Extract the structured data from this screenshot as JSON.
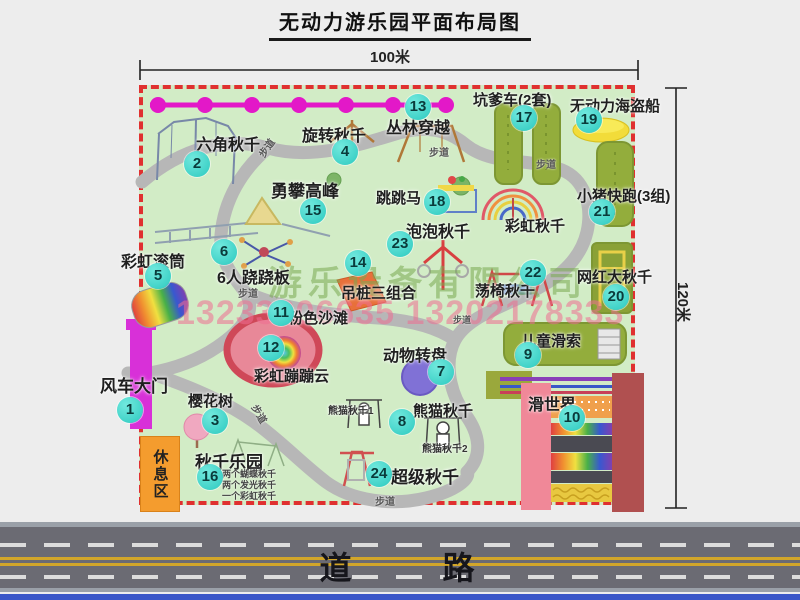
{
  "title": "无动力游乐园平面布局图",
  "dimensions": {
    "top": "100米",
    "right": "120米"
  },
  "road_label": "道 路",
  "watermark": {
    "company": "游乐设备有限公司",
    "phone": "13233806635 13202178333"
  },
  "rest_area_label": "休息区",
  "rainbow_swing_label": "彩虹秋千",
  "path_label": "步道",
  "panda_swing_labels": [
    "熊猫秋千1",
    "熊猫秋千2"
  ],
  "swing_park_notes": [
    "两个蝴蝶秋千",
    "两个发光秋千",
    "一个彩虹秋千"
  ],
  "items": [
    {
      "num": "1",
      "label": "风车大门"
    },
    {
      "num": "2",
      "label": "六角秋千"
    },
    {
      "num": "3",
      "label": "樱花树"
    },
    {
      "num": "4",
      "label": "旋转秋千"
    },
    {
      "num": "5",
      "label": "彩虹滚筒"
    },
    {
      "num": "6",
      "label": "6人跷跷板"
    },
    {
      "num": "7",
      "label": "动物转盘"
    },
    {
      "num": "8",
      "label": "熊猫秋千"
    },
    {
      "num": "9",
      "label": "儿童滑索"
    },
    {
      "num": "10",
      "label": "滑世界"
    },
    {
      "num": "11",
      "label": "粉色沙滩"
    },
    {
      "num": "12",
      "label": "彩虹蹦蹦云"
    },
    {
      "num": "13",
      "label": "丛林穿越"
    },
    {
      "num": "14",
      "label": "吊桩三组合"
    },
    {
      "num": "15",
      "label": "勇攀高峰"
    },
    {
      "num": "16",
      "label": "秋千乐园"
    },
    {
      "num": "17",
      "label": "坑爹车(2套)"
    },
    {
      "num": "18",
      "label": "跳跳马"
    },
    {
      "num": "19",
      "label": "无动力海盗船"
    },
    {
      "num": "20",
      "label": "网红大秋千"
    },
    {
      "num": "21",
      "label": "小猪快跑(3组)"
    },
    {
      "num": "22",
      "label": "荡椅秋千"
    },
    {
      "num": "23",
      "label": "泡泡秋千"
    },
    {
      "num": "24",
      "label": "超级秋千"
    }
  ]
}
